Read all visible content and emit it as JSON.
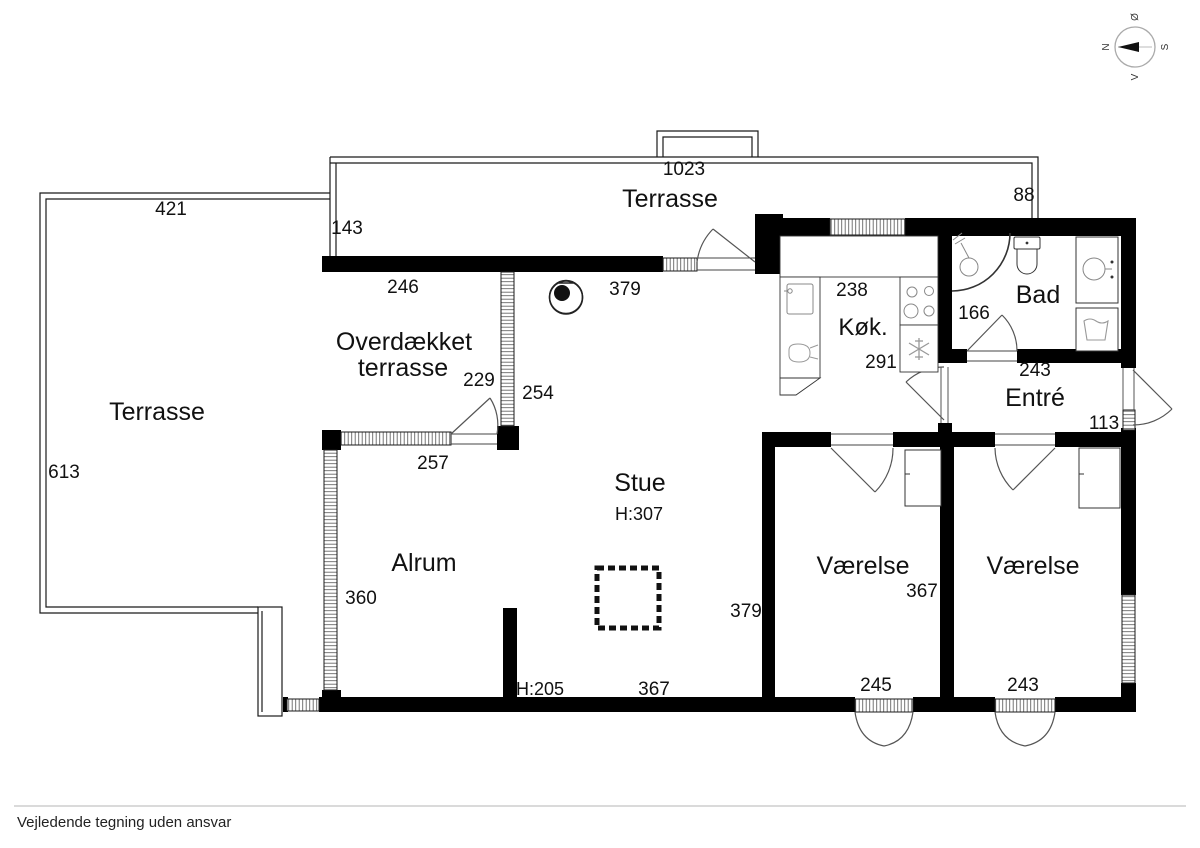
{
  "compass": {
    "north": "N",
    "east": "Ø",
    "south": "S",
    "west": "V"
  },
  "rooms": {
    "terrasse_left": {
      "label": "Terrasse"
    },
    "terrasse_top": {
      "label": "Terrasse"
    },
    "overdaekket": {
      "line1": "Overdækket",
      "line2": "terrasse"
    },
    "koekken": {
      "label": "Køk."
    },
    "bad": {
      "label": "Bad"
    },
    "entre": {
      "label": "Entré"
    },
    "stue": {
      "label": "Stue",
      "ceiling_height": "H:307"
    },
    "alrum": {
      "label": "Alrum"
    },
    "vaerelse_left": {
      "label": "Værelse"
    },
    "vaerelse_right": {
      "label": "Værelse"
    }
  },
  "dimensions": {
    "terrasse_left_width": "421",
    "terrasse_left_depth": "613",
    "terrasse_gap": "143",
    "terrasse_top_width": "1023",
    "terrasse_top_right": "88",
    "overdaekket_top": "246",
    "overdaekket_inner": "229",
    "overdaekket_depth": "254",
    "overdaekket_bottom": "257",
    "stue_top": "379",
    "koekken_width": "238",
    "koekken_depth": "291",
    "bad_width": "166",
    "entre_width": "243",
    "entre_depth": "113",
    "alrum_depth": "360",
    "stue_depth": "379",
    "stue_bottom": "367",
    "vaerelse_left_depth": "367",
    "vaerelse_left_width": "245",
    "vaerelse_right_width": "243",
    "wall_height": "H:205"
  },
  "footer": {
    "disclaimer": "Vejledende tegning uden ansvar"
  },
  "colors": {
    "wall": "#000000",
    "line": "#1a1a1a",
    "fixture": "#8a8a8a"
  }
}
